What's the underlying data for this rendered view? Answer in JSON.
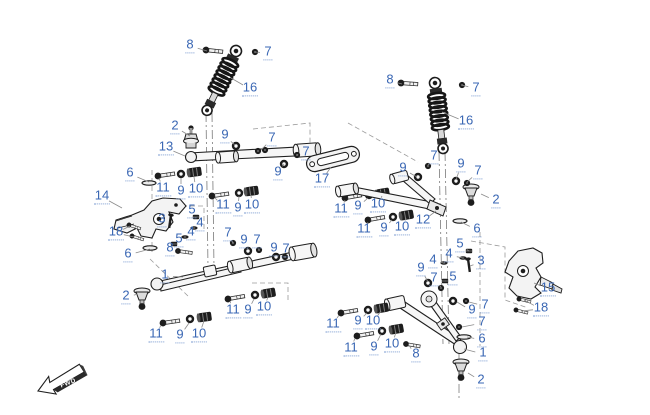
{
  "diagram": {
    "title": "front-suspension-exploded-view",
    "fwd_label": "FWD",
    "colors": {
      "callout": "#3a67b4",
      "underline": "#7b9bd0",
      "line": "#1f1f1f",
      "leader": "#8b8b8b"
    },
    "callouts": [
      {
        "n": "8",
        "x": 190,
        "y": 46,
        "tx": 207,
        "ty": 51
      },
      {
        "n": "7",
        "x": 268,
        "y": 53,
        "tx": 255,
        "ty": 52
      },
      {
        "n": "16",
        "x": 250,
        "y": 89,
        "tx": 231,
        "ty": 78
      },
      {
        "n": "2",
        "x": 175,
        "y": 127,
        "tx": 190,
        "ty": 136
      },
      {
        "n": "13",
        "x": 166,
        "y": 148,
        "tx": 185,
        "ty": 156
      },
      {
        "n": "9",
        "x": 225,
        "y": 136,
        "tx": 235,
        "ty": 145
      },
      {
        "n": "7",
        "x": 272,
        "y": 139,
        "tx": 261,
        "ty": 150
      },
      {
        "n": "7",
        "x": 306,
        "y": 153,
        "tx": 297,
        "ty": 155
      },
      {
        "n": "9",
        "x": 278,
        "y": 173,
        "tx": 284,
        "ty": 164
      },
      {
        "n": "6",
        "x": 130,
        "y": 174,
        "tx": 149,
        "ty": 182
      },
      {
        "n": "11",
        "x": 163,
        "y": 189,
        "tx": 159,
        "ty": 178
      },
      {
        "n": "9",
        "x": 181,
        "y": 192,
        "tx": 181,
        "ty": 178
      },
      {
        "n": "10",
        "x": 196,
        "y": 190,
        "tx": 194,
        "ty": 177
      },
      {
        "n": "14",
        "x": 102,
        "y": 197,
        "tx": 122,
        "ty": 208
      },
      {
        "n": "11",
        "x": 223,
        "y": 206,
        "tx": 215,
        "ty": 198
      },
      {
        "n": "9",
        "x": 238,
        "y": 209,
        "tx": 239,
        "ty": 196
      },
      {
        "n": "10",
        "x": 252,
        "y": 206,
        "tx": 251,
        "ty": 195
      },
      {
        "n": "5",
        "x": 192,
        "y": 211,
        "tx": 196,
        "ty": 217
      },
      {
        "n": "3",
        "x": 162,
        "y": 220,
        "tx": 170,
        "ty": 222
      },
      {
        "n": "4",
        "x": 200,
        "y": 224,
        "tx": 194,
        "ty": 228
      },
      {
        "n": "18",
        "x": 116,
        "y": 233,
        "tx": 130,
        "ty": 226,
        "tx2": 134,
        "ty2": 237
      },
      {
        "n": "4",
        "x": 191,
        "y": 233,
        "tx": 185,
        "ty": 237
      },
      {
        "n": "5",
        "x": 179,
        "y": 240,
        "tx": 174,
        "ty": 244
      },
      {
        "n": "8",
        "x": 170,
        "y": 249,
        "tx": 178,
        "ty": 251
      },
      {
        "n": "6",
        "x": 128,
        "y": 255,
        "tx": 150,
        "ty": 249
      },
      {
        "n": "7",
        "x": 228,
        "y": 234,
        "tx": 233,
        "ty": 243
      },
      {
        "n": "9",
        "x": 244,
        "y": 241,
        "tx": 248,
        "ty": 250
      },
      {
        "n": "7",
        "x": 257,
        "y": 241,
        "tx": 259,
        "ty": 250
      },
      {
        "n": "9",
        "x": 274,
        "y": 249,
        "tx": 276,
        "ty": 256
      },
      {
        "n": "7",
        "x": 286,
        "y": 250,
        "tx": 285,
        "ty": 257
      },
      {
        "n": "1",
        "x": 165,
        "y": 276,
        "tx": 183,
        "ty": 277
      },
      {
        "n": "2",
        "x": 126,
        "y": 297,
        "tx": 138,
        "ty": 294
      },
      {
        "n": "11",
        "x": 233,
        "y": 311,
        "tx": 230,
        "ty": 301
      },
      {
        "n": "9",
        "x": 248,
        "y": 311,
        "tx": 254,
        "ty": 299
      },
      {
        "n": "10",
        "x": 264,
        "y": 308,
        "tx": 268,
        "ty": 297
      },
      {
        "n": "11",
        "x": 156,
        "y": 335,
        "tx": 161,
        "ty": 325
      },
      {
        "n": "9",
        "x": 180,
        "y": 336,
        "tx": 189,
        "ty": 323
      },
      {
        "n": "10",
        "x": 199,
        "y": 335,
        "tx": 204,
        "ty": 321
      },
      {
        "n": "17",
        "x": 322,
        "y": 180,
        "tx": 331,
        "ty": 167
      },
      {
        "n": "9",
        "x": 403,
        "y": 169,
        "tx": 417,
        "ty": 177
      },
      {
        "n": "11",
        "x": 341,
        "y": 210,
        "tx": 345,
        "ty": 200
      },
      {
        "n": "9",
        "x": 358,
        "y": 207,
        "tx": 368,
        "ty": 198
      },
      {
        "n": "10",
        "x": 378,
        "y": 205,
        "tx": 382,
        "ty": 196
      },
      {
        "n": "11",
        "x": 364,
        "y": 230,
        "tx": 368,
        "ty": 222
      },
      {
        "n": "9",
        "x": 384,
        "y": 229,
        "tx": 392,
        "ty": 220
      },
      {
        "n": "10",
        "x": 402,
        "y": 228,
        "tx": 406,
        "ty": 218
      },
      {
        "n": "8",
        "x": 390,
        "y": 81,
        "tx": 402,
        "ty": 84
      },
      {
        "n": "7",
        "x": 476,
        "y": 89,
        "tx": 462,
        "ty": 85
      },
      {
        "n": "16",
        "x": 466,
        "y": 122,
        "tx": 442,
        "ty": 112
      },
      {
        "n": "7",
        "x": 434,
        "y": 157,
        "tx": 428,
        "ty": 165
      },
      {
        "n": "9",
        "x": 461,
        "y": 165,
        "tx": 456,
        "ty": 180
      },
      {
        "n": "7",
        "x": 478,
        "y": 172,
        "tx": 467,
        "ty": 182
      },
      {
        "n": "2",
        "x": 496,
        "y": 201,
        "tx": 481,
        "ty": 194
      },
      {
        "n": "12",
        "x": 423,
        "y": 221,
        "tx": 436,
        "ty": 211
      },
      {
        "n": "6",
        "x": 477,
        "y": 230,
        "tx": 461,
        "ty": 222
      },
      {
        "n": "5",
        "x": 460,
        "y": 245,
        "tx": 469,
        "ty": 251
      },
      {
        "n": "4",
        "x": 449,
        "y": 255,
        "tx": 463,
        "ty": 258
      },
      {
        "n": "4",
        "x": 433,
        "y": 261,
        "tx": 444,
        "ty": 263
      },
      {
        "n": "3",
        "x": 481,
        "y": 262,
        "tx": 470,
        "ty": 266
      },
      {
        "n": "5",
        "x": 453,
        "y": 278,
        "tx": 445,
        "ty": 281
      },
      {
        "n": "9",
        "x": 421,
        "y": 269,
        "tx": 428,
        "ty": 282
      },
      {
        "n": "7",
        "x": 434,
        "y": 279,
        "tx": 441,
        "ty": 287
      },
      {
        "n": "15",
        "x": 548,
        "y": 289,
        "tx": 534,
        "ty": 283
      },
      {
        "n": "18",
        "x": 541,
        "y": 309,
        "tx": 524,
        "ty": 300,
        "tx2": 521,
        "ty2": 311
      },
      {
        "n": "9",
        "x": 472,
        "y": 311,
        "tx": 457,
        "ty": 302
      },
      {
        "n": "7",
        "x": 485,
        "y": 306,
        "tx": 469,
        "ty": 302
      },
      {
        "n": "7",
        "x": 482,
        "y": 323,
        "tx": 462,
        "ty": 327
      },
      {
        "n": "6",
        "x": 482,
        "y": 340,
        "tx": 467,
        "ty": 337
      },
      {
        "n": "1",
        "x": 483,
        "y": 354,
        "tx": 464,
        "ty": 349
      },
      {
        "n": "2",
        "x": 481,
        "y": 381,
        "tx": 468,
        "ty": 373
      },
      {
        "n": "8",
        "x": 416,
        "y": 355,
        "tx": 410,
        "ty": 347
      },
      {
        "n": "11",
        "x": 333,
        "y": 325,
        "tx": 339,
        "ty": 315
      },
      {
        "n": "9",
        "x": 358,
        "y": 322,
        "tx": 367,
        "ty": 313
      },
      {
        "n": "10",
        "x": 373,
        "y": 322,
        "tx": 381,
        "ty": 311
      },
      {
        "n": "11",
        "x": 351,
        "y": 349,
        "tx": 355,
        "ty": 338
      },
      {
        "n": "9",
        "x": 374,
        "y": 348,
        "tx": 381,
        "ty": 334
      },
      {
        "n": "10",
        "x": 392,
        "y": 345,
        "tx": 396,
        "ty": 332
      }
    ]
  }
}
